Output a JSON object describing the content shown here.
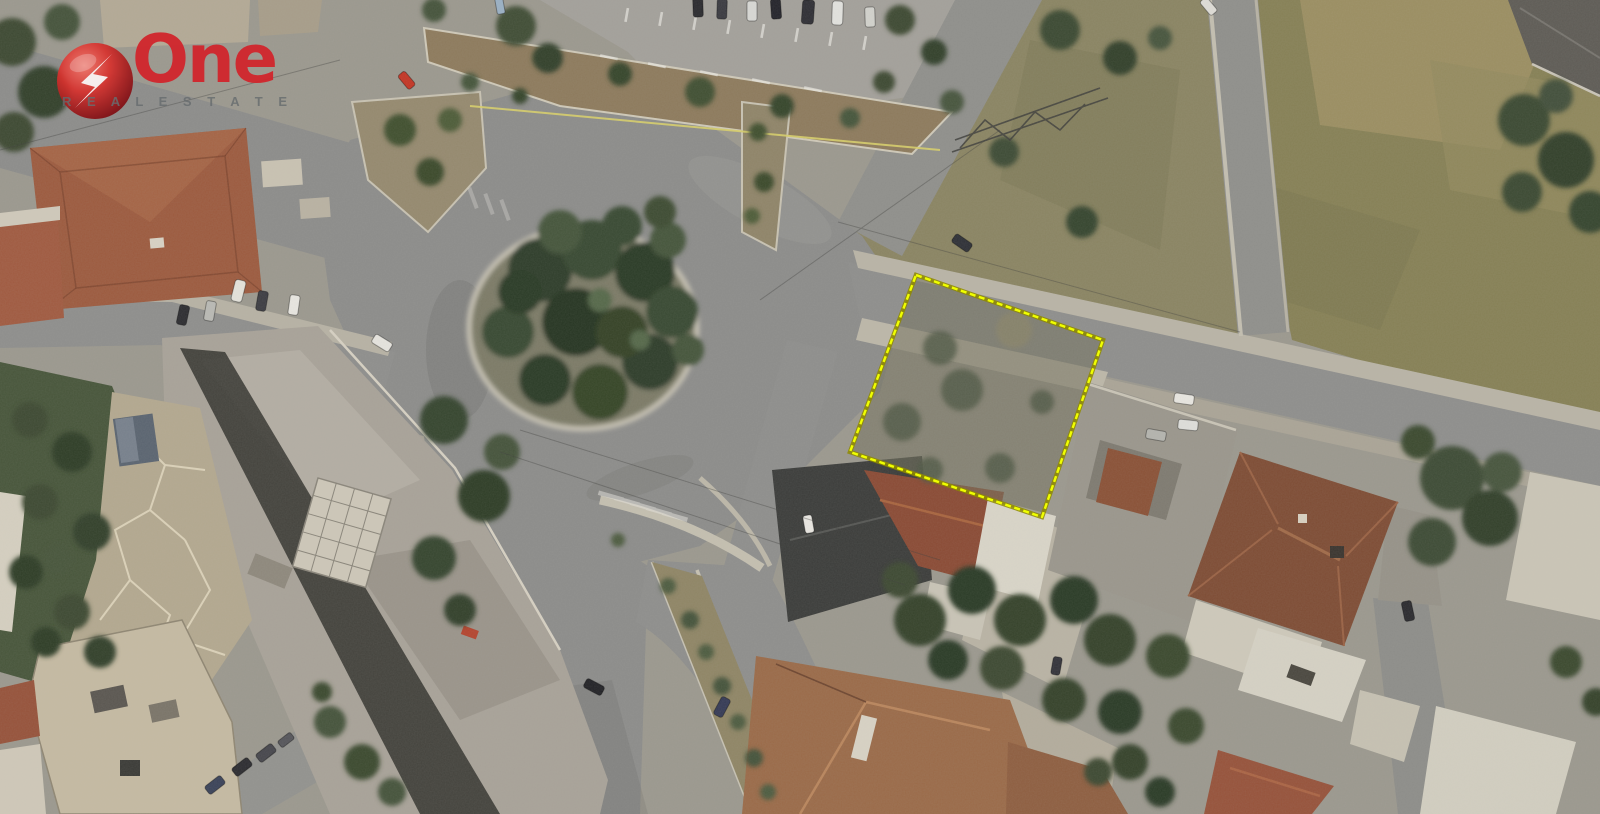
{
  "watermark": {
    "brand": "One",
    "subtitle": "R E A L   E S T A T E",
    "brand_color": "#d2232a",
    "subtitle_color": "#666b6e",
    "sphere_color": "#c9161f"
  },
  "plot": {
    "points": "916,275 1103,340 1042,517 850,452",
    "outline_color": "#f0ff00",
    "casing_color": "#8f8a00",
    "label": "highlighted land plot"
  },
  "scene": {
    "description": "Satellite aerial photo of a suburban junction: tree-filled roundabout at left, parking lot at top, vacant olive field at top right, construction site at lower left, tiled-roof houses at right and bottom, with one land plot outlined in yellow",
    "landmarks": [
      "roundabout with pine trees",
      "parking lot with marked stalls",
      "vacant field",
      "construction site",
      "red tiled roofs",
      "yellow outlined plot"
    ]
  }
}
